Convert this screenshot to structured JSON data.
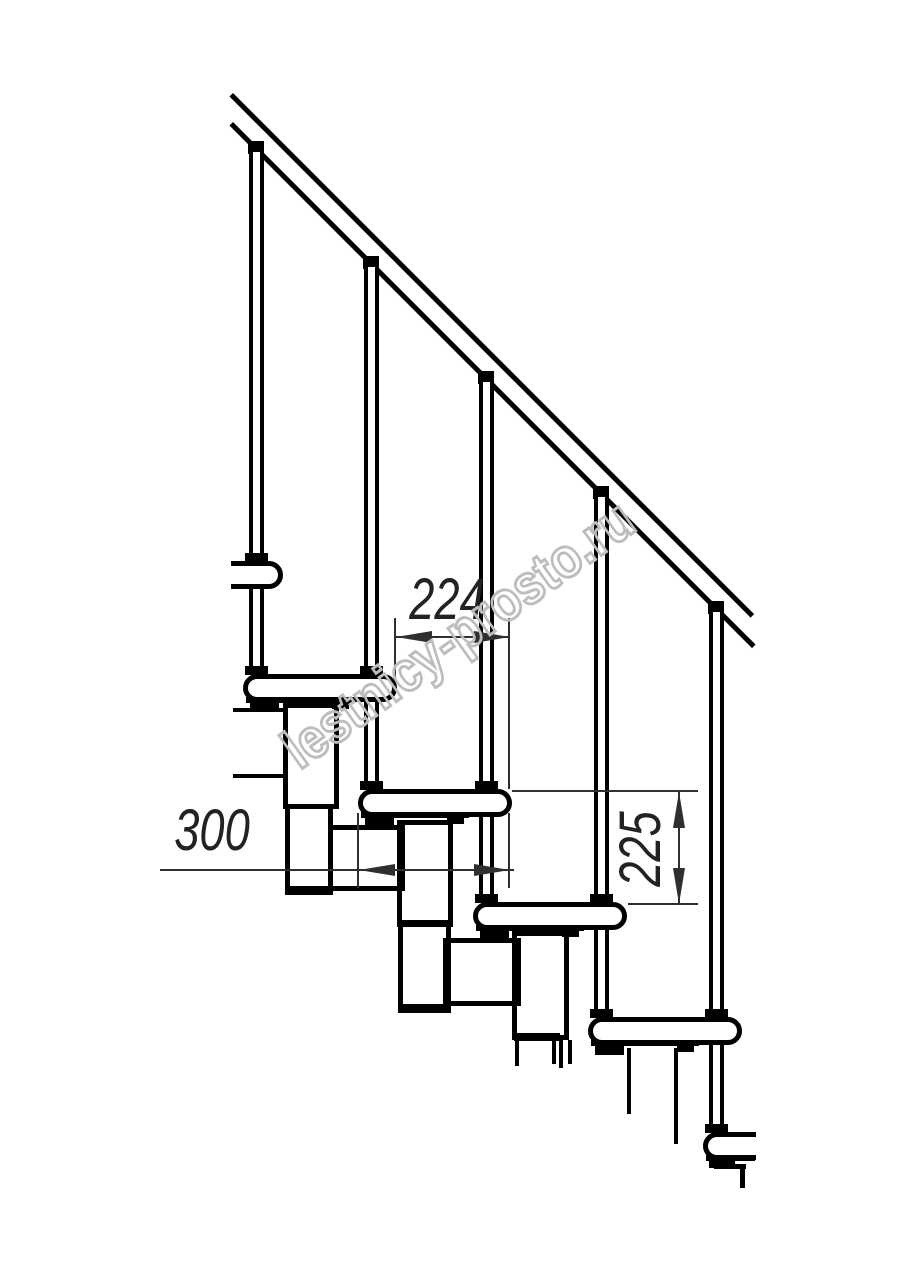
{
  "drawing": {
    "subject": "modular staircase side-view technical drawing"
  },
  "dimensions": {
    "module_spacing": "224",
    "tread_depth": "300",
    "step_rise": "225"
  },
  "watermark": {
    "text": "lestnicy-prosto.ru"
  },
  "colors": {
    "line": "#000000",
    "dimension": "#2f2f2f",
    "watermark": "#bdbdbd",
    "background": "#ffffff"
  }
}
